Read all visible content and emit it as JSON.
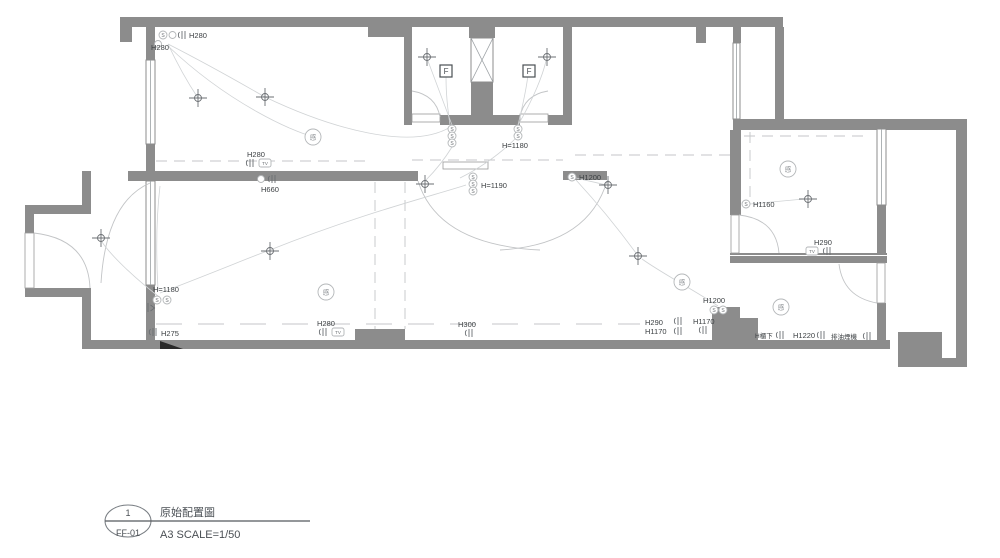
{
  "title_block": {
    "number": "1",
    "sheet": "FF-01",
    "title": "原始配置圖",
    "scale": "A3 SCALE=1/50"
  },
  "glyphs": {
    "switch": "S",
    "tv": "TV",
    "fan": "F",
    "sensor": "感"
  },
  "labels": {
    "tl_h280_a": "H280",
    "tl_h280_b": "H280",
    "room1_outlet_h280": "H280",
    "h660": "H660",
    "bath_h1180": "H=1180",
    "hall_h1190": "H=1190",
    "hall_h1200": "H1200",
    "bed_h1160": "H1160",
    "bed_h290": "H290",
    "kit_h1200": "H1200",
    "entry_h1180": "H=1180",
    "entry_h275": "H275",
    "liv_h280": "H280",
    "liv_h300": "H300",
    "kit_h290": "H290",
    "kit_h1170_a": "H1170",
    "kit_h1170_b": "H1170",
    "counter_hcab": "H櫃下",
    "counter_h1220": "H1220",
    "hood": "排油煙機"
  },
  "colors": {
    "wall": "#8c8c8c",
    "text": "#3c4043",
    "line": "#9aa0a3"
  }
}
